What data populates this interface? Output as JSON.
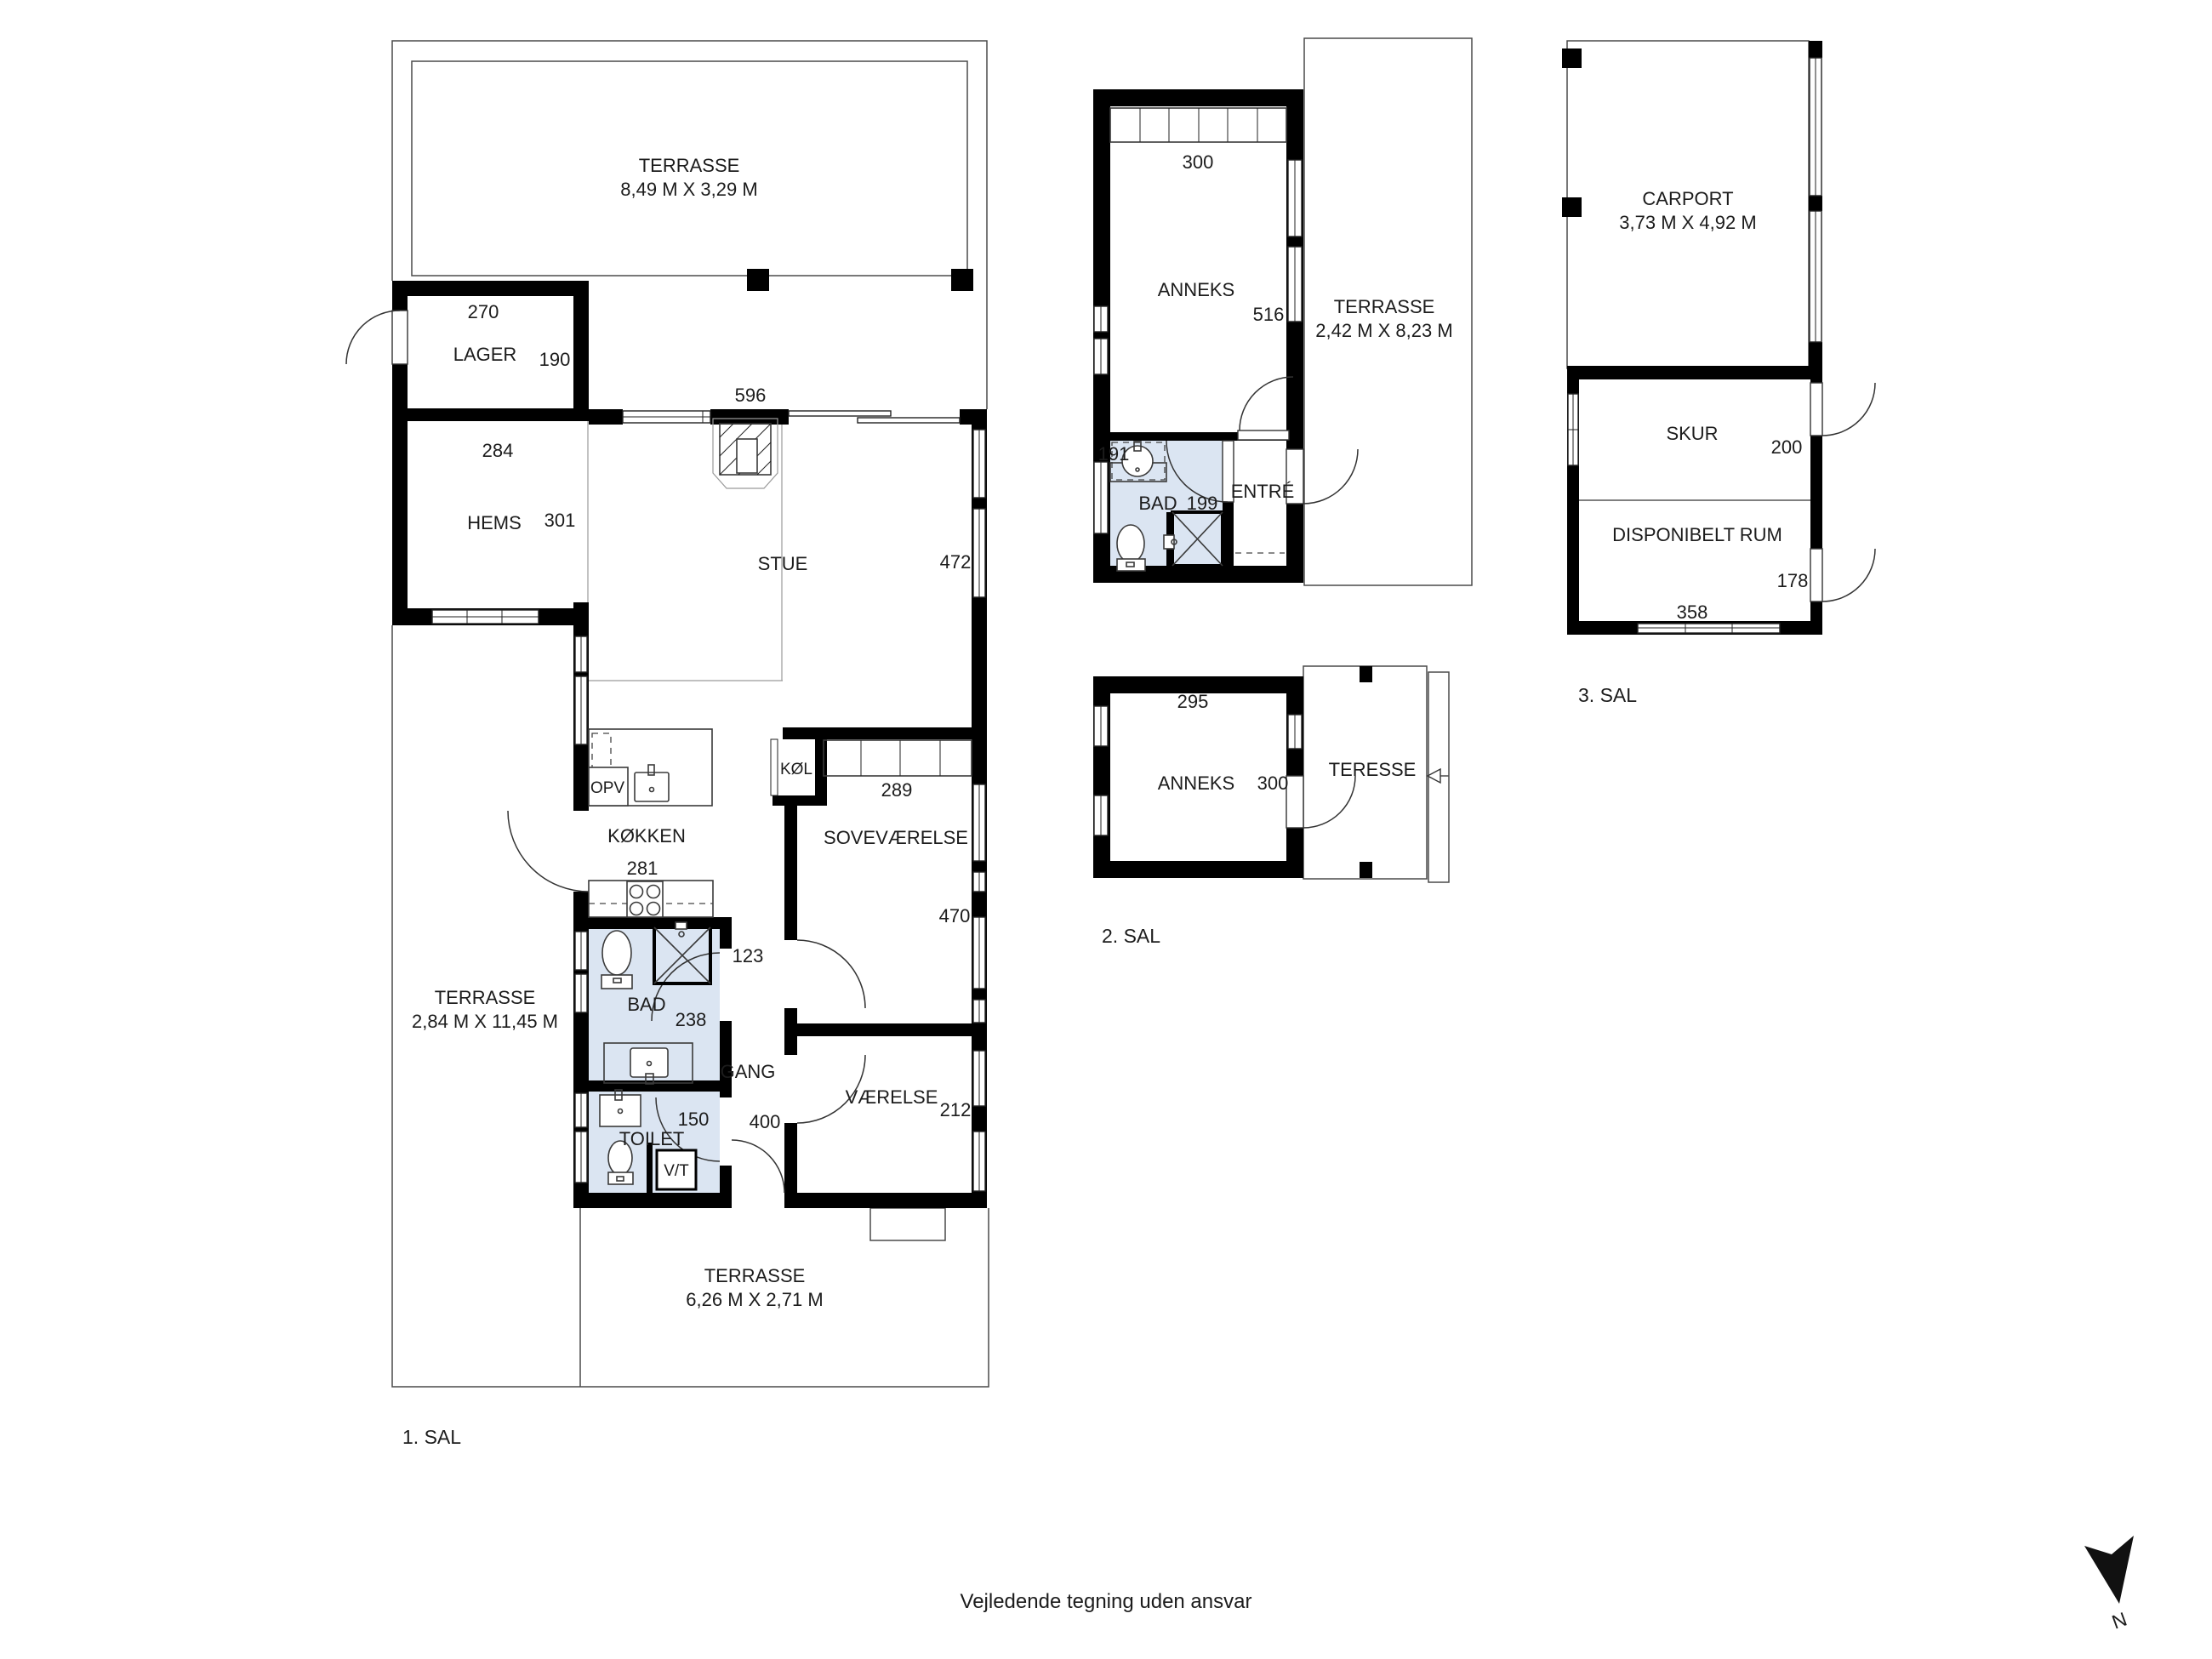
{
  "colors": {
    "wall": "#000000",
    "wet_room_fill": "#dbe5f2",
    "outline": "#4a4a4a",
    "text": "#1c1c1c"
  },
  "floor1": {
    "floor_label": "1. SAL",
    "terrace_top": {
      "name": "TERRASSE",
      "dims": "8,49 M X 3,29 M"
    },
    "terrace_left": {
      "name": "TERRASSE",
      "dims": "2,84 M X 11,45 M"
    },
    "terrace_bottom": {
      "name": "TERRASSE",
      "dims": "6,26 M X 2,71 M"
    },
    "lager": {
      "name": "LAGER",
      "width_cm": "270",
      "depth_cm": "190"
    },
    "hems": {
      "name": "HEMS",
      "width_cm": "284",
      "depth_cm": "301"
    },
    "stue": {
      "name": "STUE",
      "width_cm": "596",
      "depth_cm": "472"
    },
    "kokken": {
      "name": "KØKKEN",
      "width_cm": "281",
      "dishwasher": "OPV",
      "fridge": "KØL"
    },
    "sovevaerelse": {
      "name": "SOVEVÆRELSE",
      "width_cm": "289",
      "depth_cm": "470"
    },
    "gang": {
      "name": "GANG",
      "width_top_cm": "123",
      "width_bottom_cm": "400"
    },
    "bad": {
      "name": "BAD",
      "width_cm": "238"
    },
    "toilet": {
      "name": "TOILET",
      "width_cm": "150",
      "vt": "V/T"
    },
    "vaerelse": {
      "name": "VÆRELSE",
      "depth_cm": "212"
    }
  },
  "anneks_ground": {
    "anneks": {
      "name": "ANNEKS",
      "width_cm": "300",
      "depth_cm": "516"
    },
    "bad": {
      "name": "BAD",
      "width_cm": "191",
      "depth_cm": "199"
    },
    "entre": {
      "name": "ENTRÉ"
    },
    "terrace": {
      "name": "TERRASSE",
      "dims": "2,42 M X 8,23 M"
    }
  },
  "anneks_upper": {
    "floor_label": "2. SAL",
    "anneks": {
      "name": "ANNEKS",
      "width_cm": "295",
      "depth_cm": "300"
    },
    "terrace": {
      "name": "TERESSE"
    }
  },
  "outbuildings": {
    "floor_label": "3. SAL",
    "carport": {
      "name": "CARPORT",
      "dims": "3,73 M X 4,92 M"
    },
    "skur": {
      "name": "SKUR",
      "depth_cm": "200"
    },
    "disponibelt_rum": {
      "name": "DISPONIBELT RUM",
      "depth_cm": "178",
      "width_cm": "358"
    }
  },
  "footer": {
    "disclaimer": "Vejledende tegning uden ansvar"
  },
  "compass": {
    "north_label": "N"
  }
}
